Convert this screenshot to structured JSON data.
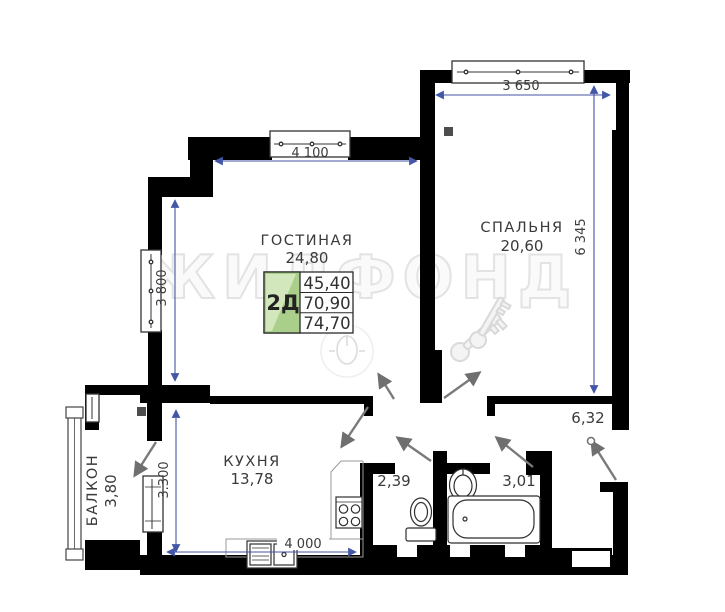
{
  "plan": {
    "watermark": "ЖИЛФОНД",
    "rooms": {
      "living": {
        "name": "ГОСТИНАЯ",
        "area": "24,80"
      },
      "bedroom": {
        "name": "СПАЛЬНЯ",
        "area": "20,60"
      },
      "kitchen": {
        "name": "КУХНЯ",
        "area": "13,78"
      },
      "balcony": {
        "name": "БАЛКОН",
        "area": "3,80"
      },
      "hall": {
        "area": "6,32"
      },
      "wc": {
        "area": "2,39"
      },
      "bathroom": {
        "area": "3,01"
      }
    },
    "info_table": {
      "type_label": "2Д",
      "rows": [
        "45,40",
        "70,90",
        "74,70"
      ]
    },
    "dimensions": {
      "living_width": "4 100",
      "bedroom_width": "3 650",
      "living_height": "3 800",
      "bedroom_height": "6 345",
      "kitchen_height": "3.300",
      "kitchen_width": "4 000"
    },
    "colors": {
      "wall": "#000000",
      "dimension_line": "#4456a6",
      "table_green": "#a9cf8a",
      "table_green_light": "#d2e7bb",
      "watermark": "#e3e3e3"
    }
  }
}
